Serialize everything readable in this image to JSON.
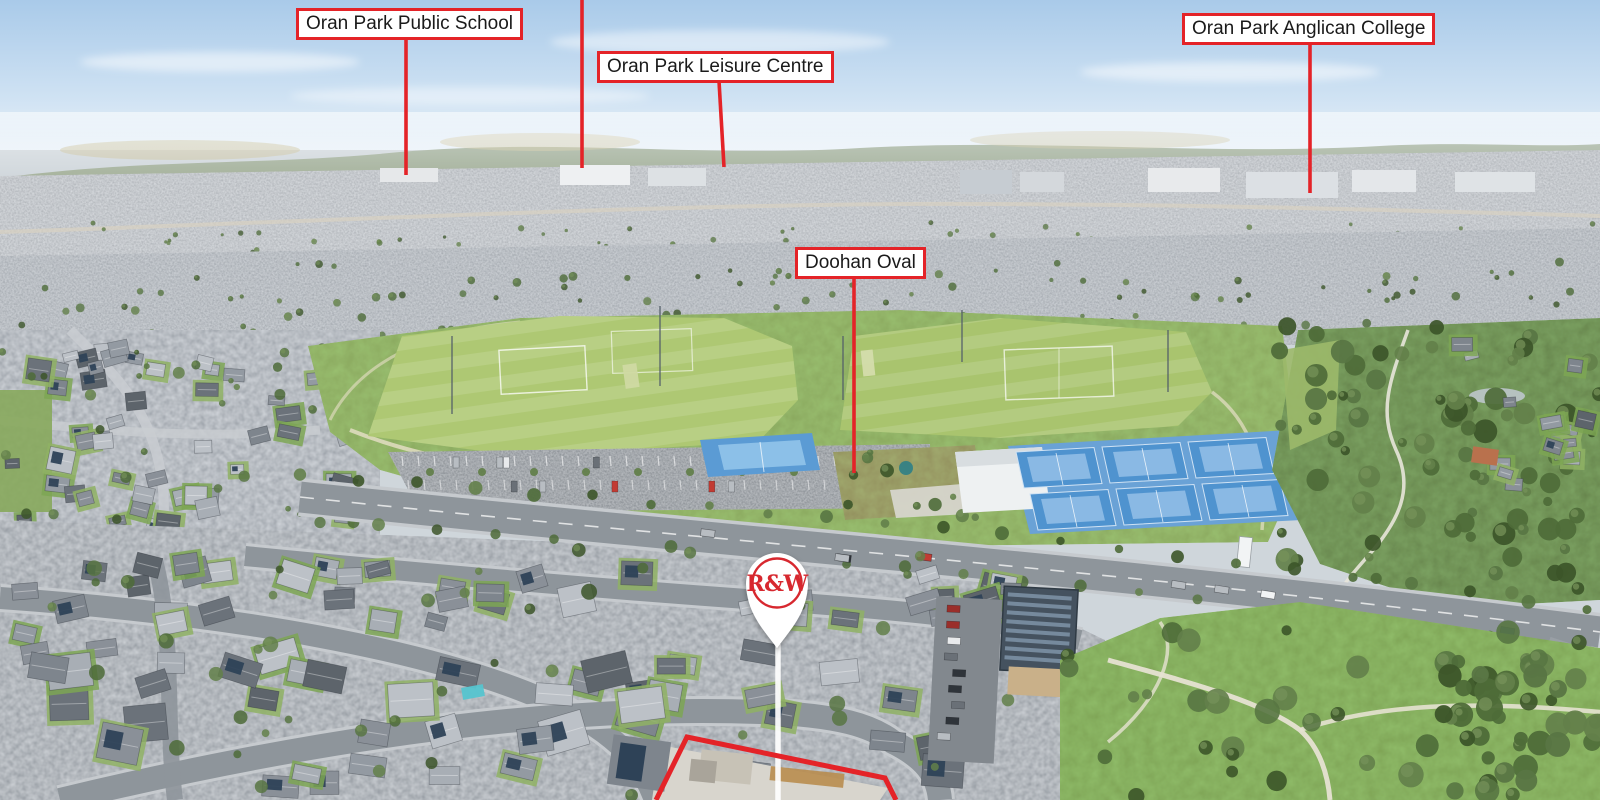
{
  "annotations": {
    "labels": [
      {
        "id": "public-school",
        "text": "Oran Park Public School"
      },
      {
        "id": "leisure-centre",
        "text": "Oran Park Leisure Centre"
      },
      {
        "id": "anglican-college",
        "text": "Oran Park Anglican College"
      },
      {
        "id": "doohan-oval",
        "text": "Doohan Oval"
      }
    ],
    "pin": {
      "brand": "R&W"
    },
    "colors": {
      "annotation_red": "#e42328",
      "label_background": "#ffffff",
      "label_text": "#1a1a1a",
      "pin_white": "#ffffff",
      "pin_red": "#d7282f"
    }
  }
}
